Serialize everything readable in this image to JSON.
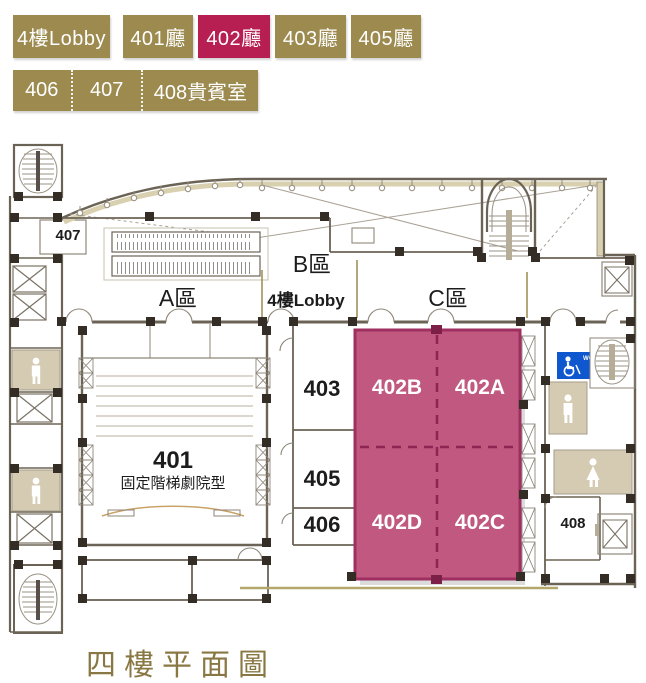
{
  "header": {
    "tabs_row1": [
      {
        "label": "4樓Lobby",
        "active": false
      },
      {
        "label": "401廳",
        "active": false
      },
      {
        "label": "402廳",
        "active": true
      },
      {
        "label": "403廳",
        "active": false
      },
      {
        "label": "405廳",
        "active": false
      }
    ],
    "tabs_row2": [
      {
        "label": "406"
      },
      {
        "label": "407"
      },
      {
        "label": "408貴賓室"
      }
    ]
  },
  "plan": {
    "zones": {
      "a": "A區",
      "b": "B區",
      "c": "C區",
      "lobby": "4樓Lobby"
    },
    "rooms": {
      "r401": "401",
      "r401_type": "固定階梯劇院型",
      "r402a": "402A",
      "r402b": "402B",
      "r402c": "402C",
      "r402d": "402D",
      "r403": "403",
      "r405": "405",
      "r406": "406",
      "r407": "407",
      "r408": "408"
    },
    "accessible_wc_label": "WC"
  },
  "footer": {
    "title": "四樓平面圖"
  },
  "colors": {
    "tab_gold": "#9c8a4f",
    "tab_active_crimson": "#b71e52",
    "highlight_pink": "#c05880",
    "highlight_border": "#9e2f60",
    "highlight_dash": "#8d2553",
    "accessible_blue": "#0f57cf",
    "restroom_tan": "#d5cab2",
    "wall_dark": "#6b6355",
    "title_gold": "#8a7844"
  }
}
